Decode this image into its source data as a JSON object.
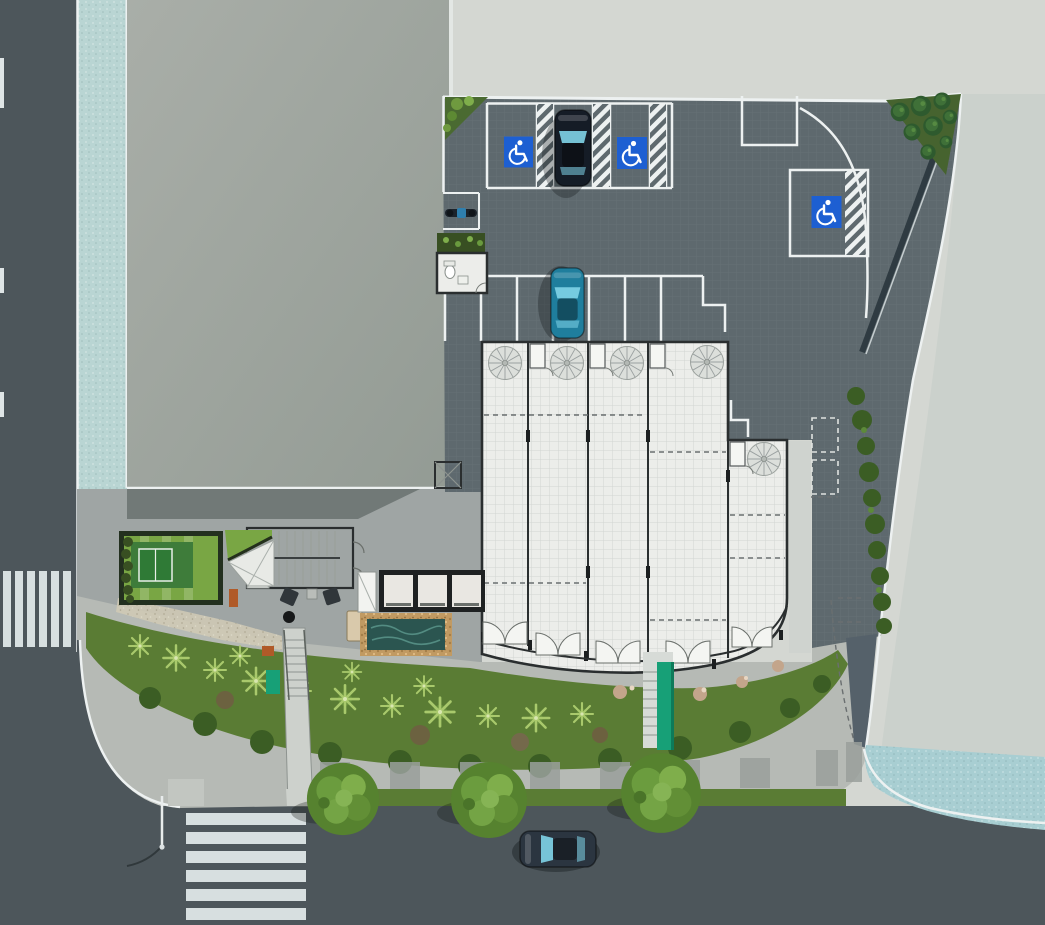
{
  "meta": {
    "kind": "architectural-site-plan-rendering",
    "view": "top-down aerial ground-floor plan",
    "canvas": "1045x925"
  },
  "colors": {
    "bg": "#d4d7d2",
    "neighbor_east": "#cbd1cc",
    "street": "#4d565b",
    "parking": "#5e696e",
    "teal_path": "#b9d5d3",
    "teal_apron": "#a8ced2",
    "roof_light": "#a9aea8",
    "roof_dark": "#939b94",
    "line_white": "#edf1f1",
    "floor": "#ecedea",
    "wall": "#2a2e2f",
    "plaza": "#9fa5a4",
    "sidewalk": "#b6bab5",
    "paving_band": "#9aa09c",
    "grass": "#5a7c34",
    "lawn": "#79a644",
    "court_green": "#2f7a36",
    "hedge": "#384f22",
    "shrub": "#3b5d24",
    "palm": "#a9c96c",
    "flower": "#c3a58b",
    "water": "#2b5550",
    "pebble": "#c19a62",
    "accessible_blue": "#1d5fd2",
    "car_dark": "#151c26",
    "car_teal": "#1f7e9d",
    "car_street": "#2b3540",
    "rail_green": "#17a077",
    "bench_orange": "#b05a28"
  },
  "scene": {
    "streets": {
      "west_street": {
        "lane_dashes": 3,
        "crosswalk_stripes": 6
      },
      "south_street": {
        "crosswalk_stripes": 6,
        "parked_cars": 1,
        "street_lamps": 1
      }
    },
    "parking_lot": {
      "accessible_spaces": 3,
      "hatched_aisles": 4,
      "standard_stall_rows": 2,
      "parked_suv": 1,
      "parked_sedan": 1,
      "parked_motorcycle": 1,
      "future_space_dashed_boxes": 2
    },
    "building": {
      "commercial_units": 5,
      "spiral_stairs": 5,
      "entrance_double_doors": 5,
      "unit_washrooms": 4,
      "accessible_washroom": 1,
      "elevator_cabs": 3,
      "service_elevator": 1,
      "stair_core": 1,
      "water_feature": 1,
      "reception_desk": 1,
      "lounge_armchairs": 2,
      "coffee_tables": 2
    },
    "roof_garden": {
      "lawns": 2,
      "table_tennis_court": 1,
      "hedge_rows": 2
    },
    "landscape": {
      "street_trees": 3,
      "conifer_bed_trees": 8,
      "palm_plants": 14,
      "shrub_clusters": 12,
      "flower_clusters": 5,
      "outdoor_stairs": 2,
      "benches": 2,
      "green_planter": 1
    },
    "neighbors": {
      "west_building_roof": 1,
      "east_lot": 1,
      "driveway_apron": 1
    }
  },
  "icons": [
    {
      "name": "wheelchair-accessible-icon",
      "count": 3
    }
  ]
}
